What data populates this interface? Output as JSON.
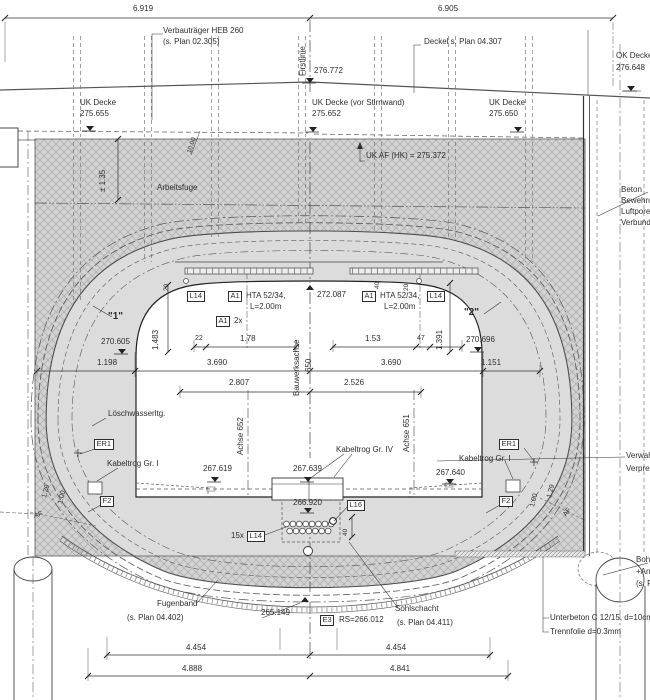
{
  "colors": {
    "line": "#3a3a3a",
    "hatch_fill": "#d3d3d3",
    "ring_fill": "#dcdcdc",
    "background": "#ffffff"
  },
  "labels": {
    "dim_6919": "6.919",
    "dim_6905": "6.905",
    "verbau1": "Verbauträger HEB 260",
    "verbau2": "(s. Plan 02.305)",
    "firstlinie": "Firstlinie",
    "deckel": "Deckel s. Plan 04.307",
    "lvl_276772": "276.772",
    "ok_decke1": "OK Decke",
    "ok_decke2": "276.648",
    "uk_decke_l1": "UK Decke",
    "uk_decke_l2": "275.655",
    "uk_decke_m1": "UK Decke (vor Stirnwand)",
    "uk_decke_m2": "275.652",
    "uk_decke_r1": "UK Decke",
    "uk_decke_r2": "275.650",
    "uk_af": "UK AF (HK) = 275.372",
    "dim_135": "± 1.35",
    "slope_10": "10.00",
    "arbeitsfuge": "Arbeitsfuge",
    "beton1": "Beton",
    "beton2": "Bewehrung",
    "beton3": "Luftporen",
    "beton4": "Verbund",
    "l14_left": "L14",
    "a1_left": "A1",
    "hta_l1": "HTA 52/34,",
    "hta_l2": "L=2.00m",
    "a1_2x_box": "A1",
    "a1_2x": "2x",
    "lvl_272087": "272.087",
    "a1_right": "A1",
    "hta_r1": "HTA 52/34,",
    "hta_r2": "L=2.00m",
    "l14_right": "L14",
    "q1": "\"1\"",
    "q2": "\"2\"",
    "dim_1483": "1.483",
    "dim_1391": "1.391",
    "dim_20a": "20",
    "dim_40a": "40",
    "dim_20b": "20",
    "lvl_270605": "270.605",
    "lvl_270696": "270.696",
    "dim_22": "22",
    "dim_178": "1.78",
    "dim_153": "1.53",
    "dim_47": "47",
    "dim_1198": "1.198",
    "dim_3690a": "3.690",
    "dim_3690b": "3.690",
    "dim_1151": "1.151",
    "dim_2807": "2.807",
    "dim_2526": "2.526",
    "achse652": "Achse 652",
    "achse651": "Achse 651",
    "bauwerksachse": "Bauwerksachse",
    "b650": "650",
    "loeschwasser": "Löschwasserltg.",
    "er1_l": "ER1",
    "er1_r": "ER1",
    "kabeltrog_l": "Kabeltrog Gr. I",
    "kabeltrog_r": "Kabeltrog Gr. I",
    "kabeltrog_m": "Kabeltrog Gr. IV",
    "lvl_267619": "267.619",
    "lvl_267639": "267.639",
    "lvl_267640": "267.640",
    "f2_l": "F2",
    "f2_r": "F2",
    "af_l": "AF",
    "af_r": "AF",
    "d129l": "1.29",
    "d100l": "1.00",
    "d100r": "1.00",
    "d129r": "1.29",
    "lvl_266920": "266.920",
    "l16": "L16",
    "d15x": "15x",
    "l14_b": "L14",
    "dim_40c": "40",
    "fugenband1": "Fugenband",
    "fugenband2": "(s. Plan 04.402)",
    "lvl_265149": "265.149",
    "e3": "E3",
    "rs266": "RS=266.012",
    "sohl1": "Sohlschacht",
    "sohl2": "(s. Plan 04.411)",
    "unterbeton": "Unterbeton C 12/15, d=10cm",
    "trennfolie": "Trennfolie d=0.3mm",
    "bohr1": "Bohrpfahl",
    "bohr2": "+Anker",
    "bohr3": "(s. Plan",
    "verwahr": "Verwahrrohr",
    "verpress": "Verpressschlauch",
    "d4454a": "4.454",
    "d4454b": "4.454",
    "d4888": "4.888",
    "d4841": "4.841"
  }
}
